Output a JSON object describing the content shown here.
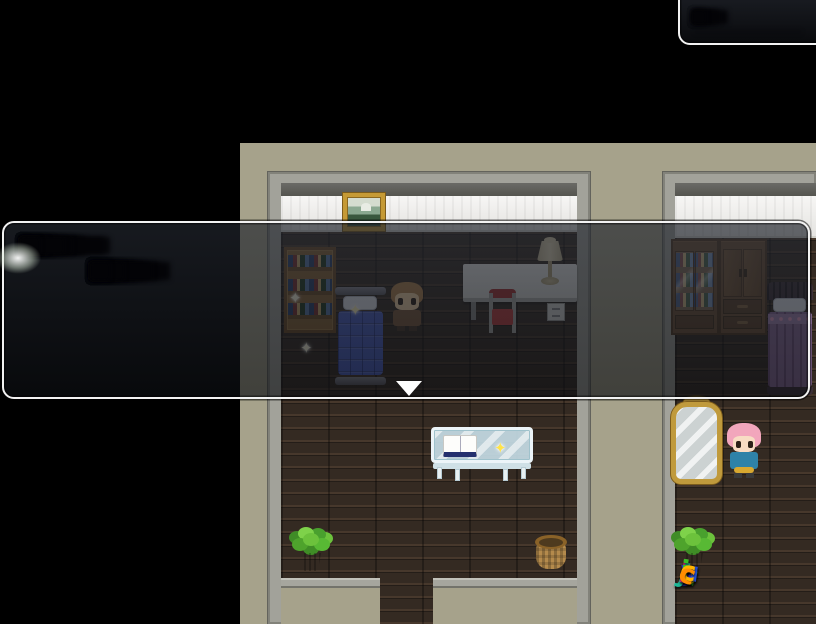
{
  "watermark": {
    "text": "luyouji.cc",
    "letters": [
      {
        "ch": "l",
        "color": "#e61680"
      },
      {
        "ch": "u",
        "color": "#2fb62a"
      },
      {
        "ch": "y",
        "color": "#3030c8"
      },
      {
        "ch": "o",
        "color": "#ffd800"
      },
      {
        "ch": "u",
        "color": "#2753d8"
      },
      {
        "ch": "j",
        "color": "#1fb898"
      },
      {
        "ch": "i",
        "color": "#35c025"
      },
      {
        "ch": ".",
        "color": "#ff3fa0"
      },
      {
        "ch": "c",
        "color": "#ffb400"
      },
      {
        "ch": "c",
        "color": "#ff8c00"
      }
    ]
  },
  "dialog": {
    "type": "message-window",
    "text_redacted": true,
    "lines": [
      {
        "left": 16,
        "top": 14,
        "h": 17,
        "chunks": [
          34,
          8,
          56,
          84,
          40,
          8,
          26,
          60,
          18,
          34,
          66,
          90,
          52,
          28,
          44,
          20
        ]
      },
      {
        "left": 86,
        "top": 39,
        "h": 18,
        "chunks": [
          44,
          22,
          70,
          30,
          8,
          54,
          18,
          40,
          80,
          26,
          48,
          62,
          34,
          20
        ]
      }
    ],
    "continue_indicator": "▼"
  },
  "popup": {
    "type": "window-fragment",
    "text_redacted": true,
    "lines": [
      {
        "left": 12,
        "top": 18,
        "h": 14,
        "chunks": [
          22,
          36,
          10,
          28,
          14
        ]
      },
      {
        "left": 14,
        "top": 38,
        "h": 4,
        "faint": true,
        "chunks": [
          108
        ]
      }
    ]
  },
  "sparkles": [
    {
      "x": 289,
      "y": 291,
      "color": "#fffbe0"
    },
    {
      "x": 300,
      "y": 341,
      "color": "#fffbe0"
    },
    {
      "x": 349,
      "y": 303,
      "color": "#fff6c0"
    },
    {
      "x": 494,
      "y": 441,
      "color": "#ffe34a"
    }
  ],
  "icons": {
    "sparkle": "✦",
    "continue": "▼"
  },
  "colors": {
    "background": "#000000",
    "wall_beige": "#a6a28b",
    "trim_gray": "#a2a29a",
    "floor_brown": "#342a22",
    "window_border": "#f2f2f2",
    "window_fill": "rgba(18,20,26,0.65)",
    "bed_blue": "#4a60c4",
    "bed_purple": "#8e6f9e",
    "chair_red": "#c03c3c",
    "mirror_gold": "#c09a3c"
  }
}
